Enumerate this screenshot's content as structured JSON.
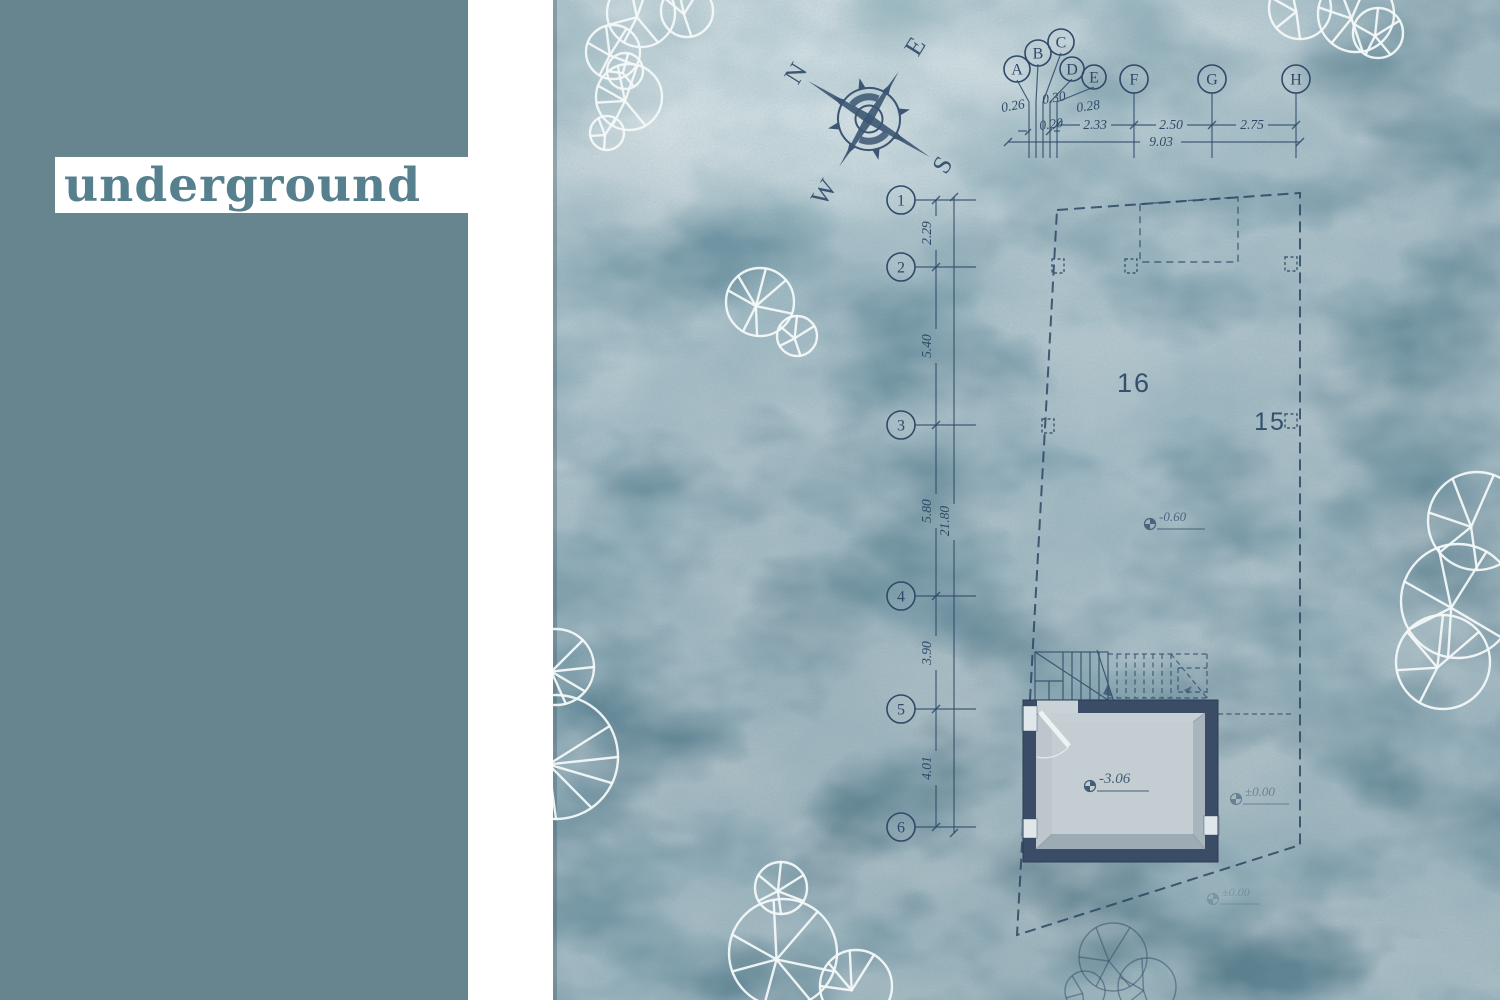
{
  "title": {
    "text": "underground"
  },
  "colors": {
    "panel": "#66858F",
    "title_text": "#56808E",
    "map_base": "#6E91A0",
    "ink": "#2E4A68",
    "boundary": "#24405E",
    "room_wall": "#3A4C66",
    "room_floor": "#C3CDD2",
    "tree_white": "#F3F8F8"
  },
  "plan": {
    "compass": {
      "n": "N",
      "e": "E",
      "s": "S",
      "w": "W"
    },
    "col": {
      "bubbles": [
        {
          "t": "A",
          "x": 1017,
          "y": 69,
          "r": 13,
          "gx": 1029
        },
        {
          "t": "B",
          "x": 1038,
          "y": 53,
          "r": 13,
          "gx": 1036
        },
        {
          "t": "C",
          "x": 1061,
          "y": 42,
          "r": 13,
          "gx": 1043
        },
        {
          "t": "D",
          "x": 1072,
          "y": 69,
          "r": 12,
          "gx": 1050
        },
        {
          "t": "E",
          "x": 1094,
          "y": 77,
          "r": 12,
          "gx": 1057
        },
        {
          "t": "F",
          "x": 1134,
          "y": 79,
          "r": 14,
          "gx": 1134
        },
        {
          "t": "G",
          "x": 1212,
          "y": 79,
          "r": 14,
          "gx": 1212
        },
        {
          "t": "H",
          "x": 1296,
          "y": 79,
          "r": 14,
          "gx": 1296
        }
      ],
      "small": [
        {
          "t": "0.26",
          "x": 1002,
          "y": 112,
          "rot": -10
        },
        {
          "t": "0.30",
          "x": 1043,
          "y": 104,
          "rot": -10
        },
        {
          "t": "0.28",
          "x": 1077,
          "y": 112,
          "rot": -8
        },
        {
          "t": "0.20",
          "x": 1040,
          "y": 130,
          "rot": -8
        }
      ],
      "spans": [
        {
          "t": "2.33",
          "x": 1095,
          "y": 129
        },
        {
          "t": "2.50",
          "x": 1171,
          "y": 129
        },
        {
          "t": "2.75",
          "x": 1252,
          "y": 129
        }
      ],
      "total": {
        "t": "9.03",
        "x": 1161,
        "y": 146
      }
    },
    "row": {
      "bubbles": [
        {
          "t": "1",
          "y": 200
        },
        {
          "t": "2",
          "y": 267
        },
        {
          "t": "3",
          "y": 425
        },
        {
          "t": "4",
          "y": 596
        },
        {
          "t": "5",
          "y": 709
        },
        {
          "t": "6",
          "y": 827
        }
      ],
      "dims": [
        {
          "t": "2.29",
          "y": 233
        },
        {
          "t": "5.40",
          "y": 346
        },
        {
          "t": "5.80",
          "y": 511
        },
        {
          "t": "3.90",
          "y": 653
        },
        {
          "t": "4.01",
          "y": 768
        }
      ],
      "total": {
        "t": "21.80",
        "y": 521
      }
    },
    "parcels": [
      {
        "t": "16",
        "x": 1134,
        "y": 392,
        "fs": 27
      },
      {
        "t": "15",
        "x": 1270,
        "y": 430,
        "fs": 25
      }
    ],
    "levels": [
      {
        "t": "-0.60",
        "x": 1150,
        "y": 524,
        "fs": 13,
        "u": 48,
        "op": 0.75
      },
      {
        "t": "-3.06",
        "x": 1090,
        "y": 786,
        "fs": 15,
        "u": 52,
        "op": 0.85
      },
      {
        "t": "±0.00",
        "x": 1236,
        "y": 799,
        "fs": 13,
        "u": 46,
        "op": 0.5
      },
      {
        "t": "±0.00",
        "x": 1213,
        "y": 899,
        "fs": 12,
        "u": 40,
        "op": 0.26
      }
    ],
    "markers": [
      [
        1058,
        266
      ],
      [
        1131,
        266
      ],
      [
        1291,
        264
      ],
      [
        1048,
        426
      ],
      [
        1291,
        421
      ]
    ],
    "trees": [
      {
        "x": 641,
        "y": 13,
        "r": 34,
        "a": [
          60,
          120,
          160,
          250,
          285
        ]
      },
      {
        "x": 687,
        "y": 11,
        "r": 26,
        "a": [
          80,
          210,
          250,
          300
        ]
      },
      {
        "x": 613,
        "y": 52,
        "r": 27,
        "a": [
          30,
          120,
          200,
          255,
          300
        ]
      },
      {
        "x": 625,
        "y": 71,
        "r": 18,
        "a": [
          60,
          180,
          280
        ]
      },
      {
        "x": 629,
        "y": 97,
        "r": 33,
        "a": [
          60,
          120,
          170,
          200,
          250,
          285
        ]
      },
      {
        "x": 607,
        "y": 133,
        "r": 17,
        "a": [
          100,
          170,
          240,
          300
        ]
      },
      {
        "x": 760,
        "y": 302,
        "r": 34,
        "a": [
          20,
          95,
          120,
          200,
          230,
          280,
          320
        ]
      },
      {
        "x": 797,
        "y": 336,
        "r": 20,
        "a": [
          80,
          150,
          210,
          270,
          330
        ]
      },
      {
        "x": 556,
        "y": 667,
        "r": 38,
        "a": [
          0,
          40,
          75,
          110,
          315
        ]
      },
      {
        "x": 556,
        "y": 757,
        "r": 62,
        "a": [
          0,
          25,
          55,
          90,
          120,
          330
        ]
      },
      {
        "x": 781,
        "y": 888,
        "r": 26,
        "a": [
          30,
          90,
          150,
          210,
          270,
          330
        ]
      },
      {
        "x": 783,
        "y": 953,
        "r": 54,
        "a": [
          20,
          60,
          110,
          160,
          200,
          260,
          310
        ]
      },
      {
        "x": 856,
        "y": 986,
        "r": 36,
        "a": [
          180,
          220,
          260,
          300
        ]
      },
      {
        "x": 1300,
        "y": 8,
        "r": 31,
        "a": [
          90,
          140,
          200,
          250
        ]
      },
      {
        "x": 1356,
        "y": 14,
        "r": 38,
        "a": [
          80,
          130,
          190,
          240,
          290
        ]
      },
      {
        "x": 1378,
        "y": 33,
        "r": 25,
        "a": [
          60,
          120,
          200,
          270,
          330
        ]
      },
      {
        "x": 1477,
        "y": 521,
        "r": 49,
        "a": [
          90,
          140,
          190,
          240,
          290
        ]
      },
      {
        "x": 1458,
        "y": 601,
        "r": 57,
        "a": [
          40,
          100,
          150,
          200,
          250,
          300
        ]
      },
      {
        "x": 1443,
        "y": 662,
        "r": 47,
        "a": [
          120,
          170,
          220,
          270,
          320
        ]
      },
      {
        "x": 1113,
        "y": 957,
        "r": 34,
        "a": [
          60,
          120,
          180,
          240,
          300
        ],
        "dark": true
      },
      {
        "x": 1147,
        "y": 987,
        "r": 29,
        "a": [
          80,
          140,
          200,
          260
        ],
        "dark": true
      },
      {
        "x": 1085,
        "y": 991,
        "r": 20,
        "a": [
          90,
          160,
          230
        ],
        "dark": true
      }
    ]
  }
}
